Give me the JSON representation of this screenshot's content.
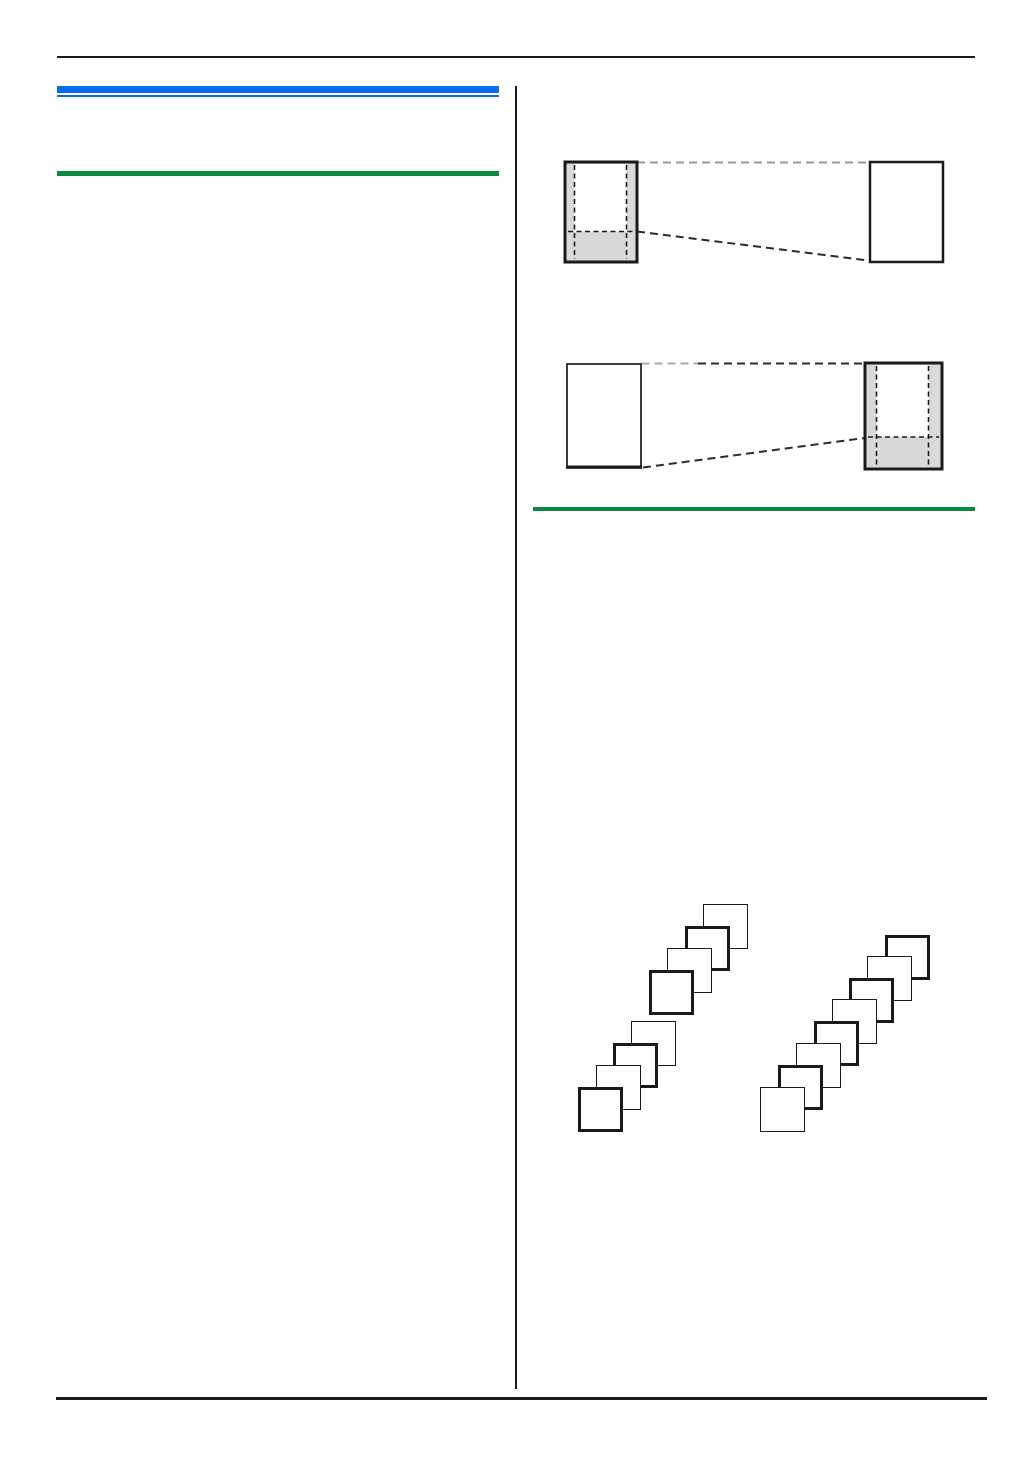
{
  "page": {
    "kind": "printed-manual-page",
    "background": "#ffffff",
    "colors": {
      "rule_black": "#1a1a1a",
      "accent_blue": "#0b6cee",
      "accent_green": "#0a8a3e",
      "diagram_gray": "#d9d9d9",
      "connector_gray": "#999999",
      "connector_dark": "#2b2b2b"
    },
    "left_column": {
      "decorations": [
        "blue-heading-bar",
        "blue-thin-rule",
        "green-section-rule"
      ]
    },
    "right_column": {
      "diagrams": [
        {
          "name": "copy-reduction-diagram",
          "left_page": "original-page-shaded-margins-dashed-print-area",
          "right_page": "blank-copy-page",
          "connectors": [
            "top-horizontal-gray-dashed",
            "bottom-slanted-dark-dashed"
          ]
        },
        {
          "name": "copy-enlargement-diagram",
          "left_page": "blank-original-page",
          "right_page": "copy-page-shaded-margins-dashed-print-area",
          "connectors": [
            "top-horizontal-gray-to-dark-dashed",
            "bottom-slanted-dark-dashed"
          ]
        }
      ],
      "collate_diagram": {
        "sheet_size": 45,
        "stacks": [
          {
            "name": "collated-stack",
            "groups": 2,
            "sheets_per_group": 4,
            "sheets": [
              [
                703,
                904
              ],
              [
                685,
                926
              ],
              [
                667,
                948
              ],
              [
                649,
                970
              ],
              [
                631,
                1021
              ],
              [
                613,
                1043
              ],
              [
                596,
                1065
              ],
              [
                578,
                1087
              ]
            ],
            "weights": [
              "thin",
              "thick",
              "thin",
              "thick",
              "thin",
              "thick",
              "thin",
              "thick"
            ]
          },
          {
            "name": "uncollated-stack",
            "groups": 1,
            "sheets_per_group": 8,
            "sheets": [
              [
                885,
                935
              ],
              [
                867,
                956
              ],
              [
                849,
                978
              ],
              [
                832,
                999
              ],
              [
                814,
                1021
              ],
              [
                796,
                1043
              ],
              [
                778,
                1065
              ],
              [
                760,
                1087
              ]
            ],
            "weights": [
              "thick",
              "thin",
              "thick",
              "thin",
              "thick",
              "thin",
              "thick",
              "thin"
            ]
          }
        ]
      }
    }
  }
}
